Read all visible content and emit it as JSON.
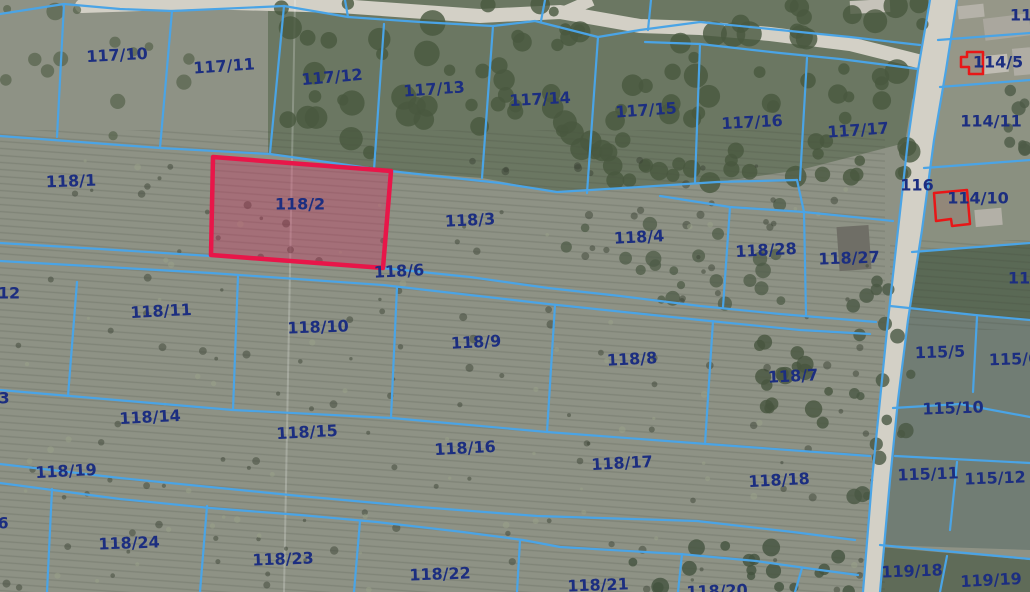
{
  "map": {
    "type": "cadastral-parcel-map-over-aerial-imagery",
    "selected_parcel": "118/2",
    "colors": {
      "boundary_blue": "#4aa4e6",
      "label_navy": "#1c2e80",
      "highlight_red": "#e81649",
      "highlight_fill": "rgba(210,40,95,0.33)",
      "building_outline_red": "#e81717",
      "road_gray": "#d3d0c6"
    },
    "labels": [
      {
        "text": "117/10",
        "x": 117,
        "y": 55,
        "rot": -3
      },
      {
        "text": "117/11",
        "x": 224,
        "y": 66,
        "rot": -4
      },
      {
        "text": "117/12",
        "x": 332,
        "y": 77,
        "rot": -5
      },
      {
        "text": "117/13",
        "x": 434,
        "y": 89,
        "rot": -4
      },
      {
        "text": "117/14",
        "x": 540,
        "y": 99,
        "rot": -3
      },
      {
        "text": "117/15",
        "x": 646,
        "y": 110,
        "rot": -4
      },
      {
        "text": "117/16",
        "x": 752,
        "y": 122,
        "rot": -3
      },
      {
        "text": "117/17",
        "x": 858,
        "y": 130,
        "rot": -4
      },
      {
        "text": "11",
        "x": 1021,
        "y": 15,
        "rot": 0
      },
      {
        "text": "114/5",
        "x": 998,
        "y": 62,
        "rot": 0
      },
      {
        "text": "114/11",
        "x": 991,
        "y": 121,
        "rot": 0
      },
      {
        "text": "118/1",
        "x": 71,
        "y": 181,
        "rot": -2
      },
      {
        "text": "118/2",
        "x": 300,
        "y": 204,
        "rot": 0
      },
      {
        "text": "118/3",
        "x": 470,
        "y": 220,
        "rot": -3
      },
      {
        "text": "118/4",
        "x": 639,
        "y": 237,
        "rot": -3
      },
      {
        "text": "118/28",
        "x": 766,
        "y": 250,
        "rot": -3
      },
      {
        "text": "118/27",
        "x": 849,
        "y": 258,
        "rot": -2
      },
      {
        "text": "116",
        "x": 917,
        "y": 185,
        "rot": 0
      },
      {
        "text": "114/10",
        "x": 978,
        "y": 198,
        "rot": 0
      },
      {
        "text": "118/6",
        "x": 399,
        "y": 271,
        "rot": -3
      },
      {
        "text": "12",
        "x": 9,
        "y": 293,
        "rot": 0
      },
      {
        "text": "118/11",
        "x": 161,
        "y": 311,
        "rot": -3
      },
      {
        "text": "118/10",
        "x": 318,
        "y": 327,
        "rot": -2
      },
      {
        "text": "118/9",
        "x": 476,
        "y": 342,
        "rot": -3
      },
      {
        "text": "118/8",
        "x": 632,
        "y": 359,
        "rot": -3
      },
      {
        "text": "118/7",
        "x": 793,
        "y": 376,
        "rot": -3
      },
      {
        "text": "11",
        "x": 1019,
        "y": 278,
        "rot": 0
      },
      {
        "text": "115/5",
        "x": 940,
        "y": 352,
        "rot": -2
      },
      {
        "text": "115/6",
        "x": 1014,
        "y": 359,
        "rot": -2
      },
      {
        "text": "115/10",
        "x": 953,
        "y": 408,
        "rot": -2
      },
      {
        "text": "3",
        "x": 4,
        "y": 398,
        "rot": 0
      },
      {
        "text": "118/14",
        "x": 150,
        "y": 417,
        "rot": -3
      },
      {
        "text": "118/15",
        "x": 307,
        "y": 432,
        "rot": -3
      },
      {
        "text": "118/16",
        "x": 465,
        "y": 448,
        "rot": -3
      },
      {
        "text": "118/17",
        "x": 622,
        "y": 463,
        "rot": -3
      },
      {
        "text": "118/18",
        "x": 779,
        "y": 480,
        "rot": -3
      },
      {
        "text": "118/19",
        "x": 66,
        "y": 471,
        "rot": -3
      },
      {
        "text": "115/11",
        "x": 928,
        "y": 474,
        "rot": -2
      },
      {
        "text": "115/12",
        "x": 995,
        "y": 478,
        "rot": -2
      },
      {
        "text": "6",
        "x": 3,
        "y": 523,
        "rot": 0
      },
      {
        "text": "118/24",
        "x": 129,
        "y": 543,
        "rot": -2
      },
      {
        "text": "118/23",
        "x": 283,
        "y": 559,
        "rot": -2
      },
      {
        "text": "118/22",
        "x": 440,
        "y": 574,
        "rot": -2
      },
      {
        "text": "118/21",
        "x": 598,
        "y": 585,
        "rot": -2
      },
      {
        "text": "118/20",
        "x": 717,
        "y": 591,
        "rot": -2
      },
      {
        "text": "119/18",
        "x": 912,
        "y": 571,
        "rot": -2
      },
      {
        "text": "119/19",
        "x": 991,
        "y": 580,
        "rot": -3
      }
    ]
  }
}
